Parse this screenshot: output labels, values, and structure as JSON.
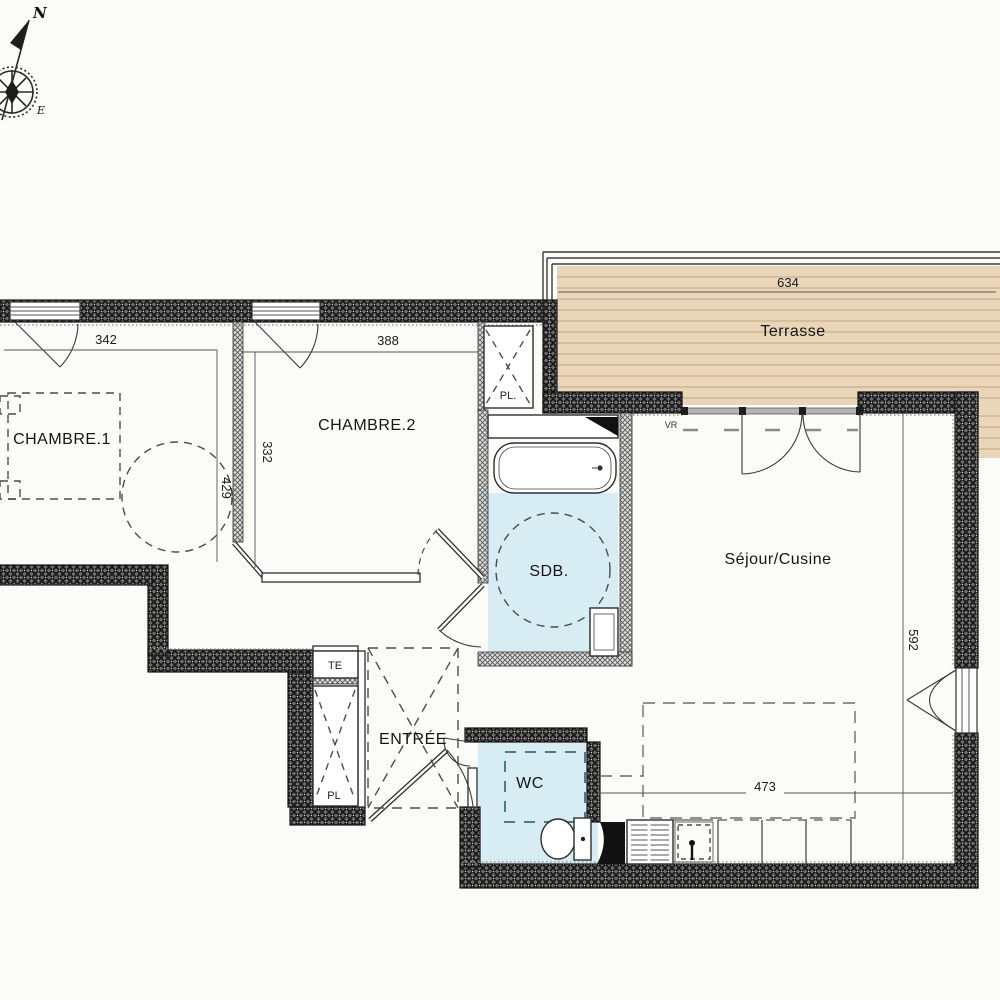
{
  "rooms": {
    "chambre1": "CHAMBRE.1",
    "chambre2": "CHAMBRE.2",
    "sdb": "SDB.",
    "sejour_cuisine": "Séjour/Cusine",
    "entree": "ENTRÉE",
    "wc": "WC",
    "terrasse": "Terrasse"
  },
  "closets": {
    "te": "TE",
    "pl_upper": "PL.",
    "pl_lower": "PL"
  },
  "annotations": {
    "shutter": "VR"
  },
  "compass": {
    "north": "N",
    "east": "E"
  },
  "dimensions": {
    "chambre1_width": "342",
    "chambre2_width": "388",
    "chambre1_depth": "429",
    "chambre2_depth": "332",
    "terrasse_width": "634",
    "sejour_depth": "592",
    "sejour_width": "473"
  },
  "colors": {
    "bg": "#fbfbf8",
    "wood": "#e9d6ba",
    "wood_line": "#c2a57b",
    "water_blue": "#d7edf3",
    "wall_dark": "#6b6b6b",
    "dash_teal": "#4a7b8f",
    "dim": "#555555"
  }
}
